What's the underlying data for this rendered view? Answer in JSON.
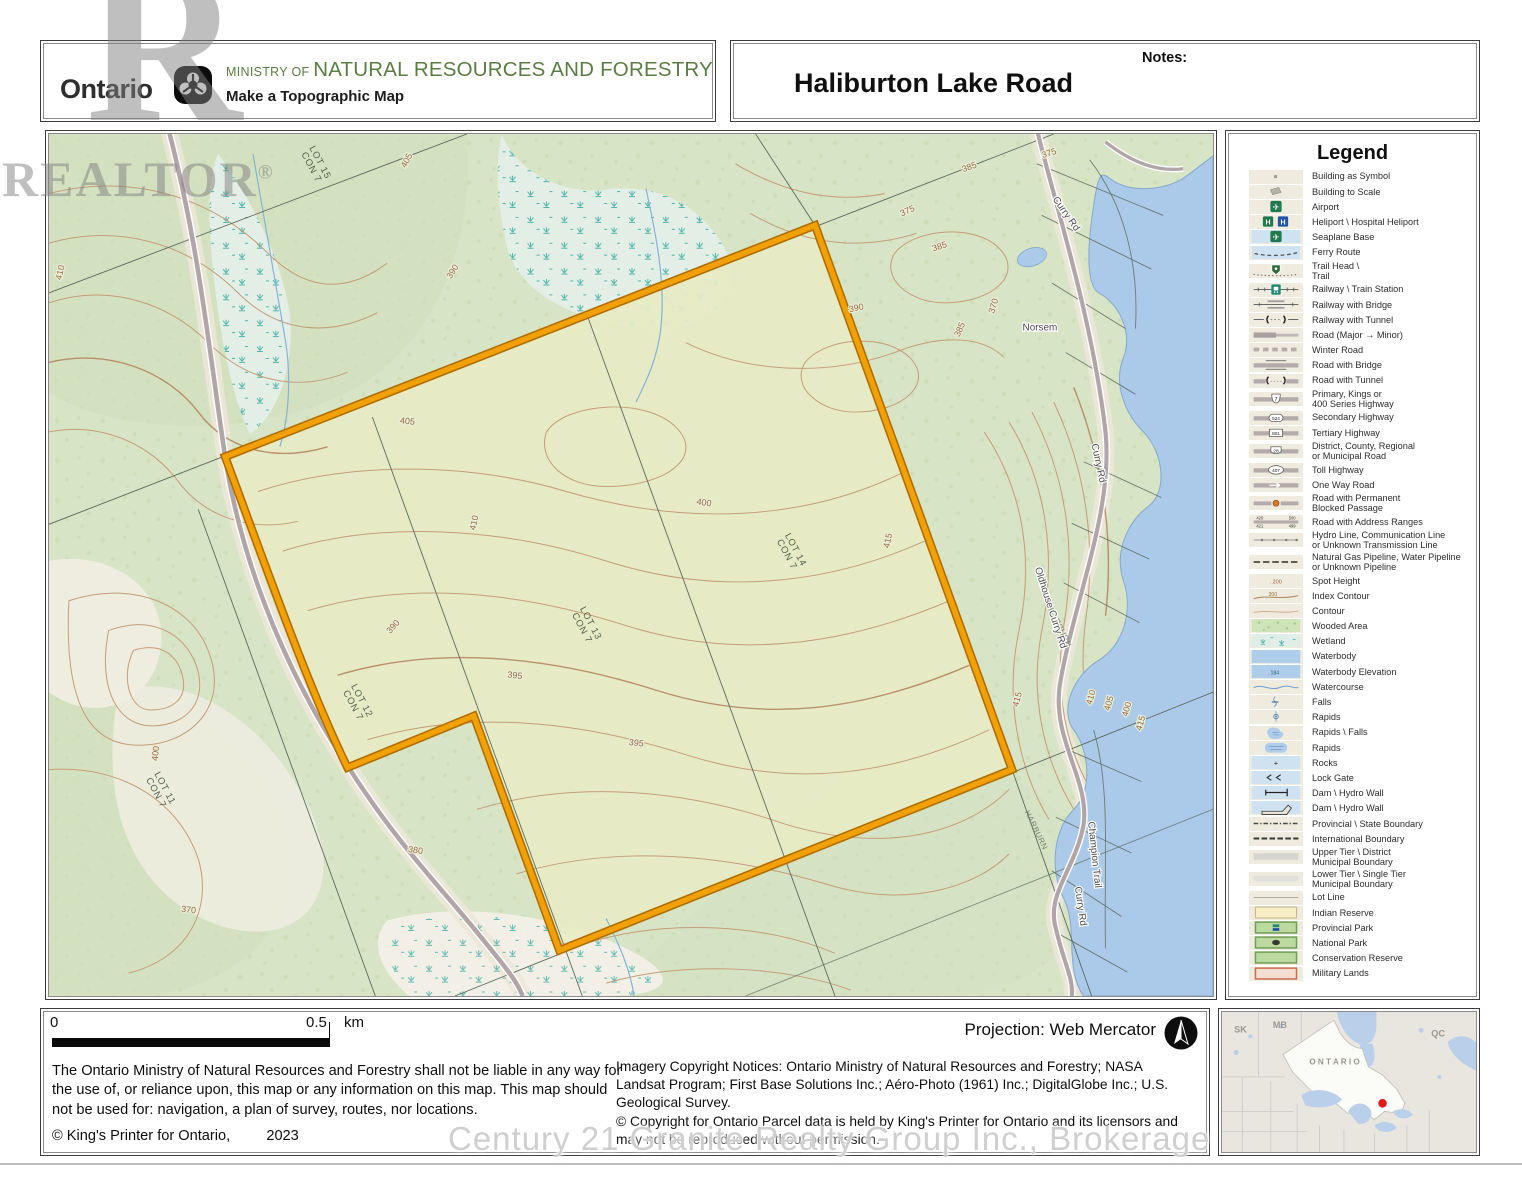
{
  "header": {
    "brand": "Ontario",
    "ministry_prefix": "MINISTRY OF ",
    "ministry_name": "NATURAL RESOURCES AND FORESTRY",
    "app_title": "Make a Topographic Map",
    "map_title": "Haliburton Lake Road",
    "notes_label": "Notes:"
  },
  "watermarks": {
    "realtor_r": "R",
    "realtor": "REALTOR",
    "registered": "®",
    "brokerage": "Century 21 Granite Realty Group Inc., Brokerage"
  },
  "legend": {
    "title": "Legend",
    "items": [
      {
        "label": "Building as Symbol",
        "sym": "building-symbol"
      },
      {
        "label": "Building to Scale",
        "sym": "building-scale"
      },
      {
        "label": "Airport",
        "sym": "airport"
      },
      {
        "label": "Heliport \\ Hospital Heliport",
        "sym": "heliport"
      },
      {
        "label": "Seaplane Base",
        "sym": "seaplane"
      },
      {
        "label": "Ferry Route",
        "sym": "ferry"
      },
      {
        "label": "Trail Head \\\nTrail",
        "sym": "trail"
      },
      {
        "label": "Railway \\ Train Station",
        "sym": "railway-station"
      },
      {
        "label": "Railway with Bridge",
        "sym": "railway-bridge"
      },
      {
        "label": "Railway with Tunnel",
        "sym": "railway-tunnel"
      },
      {
        "label": "Road (Major → Minor)",
        "sym": "road-major-minor"
      },
      {
        "label": "Winter Road",
        "sym": "winter-road"
      },
      {
        "label": "Road with Bridge",
        "sym": "road-bridge"
      },
      {
        "label": "Road with Tunnel",
        "sym": "road-tunnel"
      },
      {
        "label": "Primary, Kings or\n400 Series Highway",
        "sym": "hwy-primary",
        "num": "7"
      },
      {
        "label": "Secondary Highway",
        "sym": "hwy-secondary",
        "num": "524"
      },
      {
        "label": "Tertiary Highway",
        "sym": "hwy-tertiary",
        "num": "801"
      },
      {
        "label": "District, County, Regional\nor Municipal Road",
        "sym": "road-district",
        "num": "28"
      },
      {
        "label": "Toll Highway",
        "sym": "hwy-toll",
        "num": "407"
      },
      {
        "label": "One Way Road",
        "sym": "one-way"
      },
      {
        "label": "Road with Permanent\nBlocked Passage",
        "sym": "road-blocked"
      },
      {
        "label": "Road with Address Ranges",
        "sym": "road-address",
        "nums": [
          "420",
          "500",
          "421",
          "499"
        ]
      },
      {
        "label": "Hydro Line, Communication Line\nor Unknown Transmission Line",
        "sym": "hydro-line"
      },
      {
        "label": "Natural Gas Pipeline, Water Pipeline\nor Unknown Pipeline",
        "sym": "pipeline"
      },
      {
        "label": "Spot Height",
        "sym": "spot-height",
        "num": "200"
      },
      {
        "label": "Index Contour",
        "sym": "index-contour",
        "num": "200"
      },
      {
        "label": "Contour",
        "sym": "contour"
      },
      {
        "label": "Wooded Area",
        "sym": "wooded"
      },
      {
        "label": "Wetland",
        "sym": "wetland"
      },
      {
        "label": "Waterbody",
        "sym": "waterbody"
      },
      {
        "label": "Waterbody Elevation",
        "sym": "waterbody-elev",
        "num": "184"
      },
      {
        "label": "Watercourse",
        "sym": "watercourse"
      },
      {
        "label": "Falls",
        "sym": "falls"
      },
      {
        "label": "Rapids",
        "sym": "rapids-dot"
      },
      {
        "label": "Rapids \\ Falls",
        "sym": "rapids-falls"
      },
      {
        "label": "Rapids",
        "sym": "rapids-area"
      },
      {
        "label": "Rocks",
        "sym": "rocks"
      },
      {
        "label": "Lock Gate",
        "sym": "lock-gate"
      },
      {
        "label": "Dam \\ Hydro Wall",
        "sym": "dam1"
      },
      {
        "label": "Dam \\ Hydro Wall",
        "sym": "dam2"
      },
      {
        "label": "Provincial \\ State Boundary",
        "sym": "prov-boundary"
      },
      {
        "label": "International Boundary",
        "sym": "intl-boundary"
      },
      {
        "label": "Upper Tier \\ District\nMunicipal Boundary",
        "sym": "upper-tier"
      },
      {
        "label": "Lower Tier \\ Single Tier\nMunicipal Boundary",
        "sym": "lower-tier"
      },
      {
        "label": "Lot Line",
        "sym": "lot-line"
      },
      {
        "label": "Indian Reserve",
        "sym": "indian-reserve"
      },
      {
        "label": "Provincial Park",
        "sym": "prov-park"
      },
      {
        "label": "National Park",
        "sym": "natl-park"
      },
      {
        "label": "Conservation Reserve",
        "sym": "conservation"
      },
      {
        "label": "Military Lands",
        "sym": "military"
      }
    ]
  },
  "map": {
    "contour_labels": [
      {
        "t": "405",
        "x": 362,
        "y": 28,
        "r": -62
      },
      {
        "t": "410",
        "x": 14,
        "y": 140,
        "r": -78
      },
      {
        "t": "390",
        "x": 408,
        "y": 140,
        "r": -58
      },
      {
        "t": "375",
        "x": 1006,
        "y": 22,
        "r": -18
      },
      {
        "t": "385",
        "x": 926,
        "y": 36,
        "r": -20
      },
      {
        "t": "375",
        "x": 864,
        "y": 80,
        "r": -24
      },
      {
        "t": "385",
        "x": 896,
        "y": 116,
        "r": -18
      },
      {
        "t": "390",
        "x": 812,
        "y": 178,
        "r": -12
      },
      {
        "t": "370",
        "x": 952,
        "y": 174,
        "r": -72
      },
      {
        "t": "385",
        "x": 918,
        "y": 198,
        "r": -66
      },
      {
        "t": "405",
        "x": 360,
        "y": 292,
        "r": 6
      },
      {
        "t": "410",
        "x": 430,
        "y": 392,
        "r": -78
      },
      {
        "t": "400",
        "x": 658,
        "y": 374,
        "r": 8
      },
      {
        "t": "415",
        "x": 846,
        "y": 410,
        "r": -78
      },
      {
        "t": "395",
        "x": 468,
        "y": 548,
        "r": 6
      },
      {
        "t": "395",
        "x": 590,
        "y": 616,
        "r": 6
      },
      {
        "t": "390",
        "x": 348,
        "y": 498,
        "r": -48
      },
      {
        "t": "400",
        "x": 110,
        "y": 624,
        "r": -84
      },
      {
        "t": "380",
        "x": 368,
        "y": 724,
        "r": 8
      },
      {
        "t": "370",
        "x": 140,
        "y": 784,
        "r": 6
      },
      {
        "t": "415",
        "x": 976,
        "y": 570,
        "r": -74
      },
      {
        "t": "410",
        "x": 1050,
        "y": 568,
        "r": -74
      },
      {
        "t": "405",
        "x": 1068,
        "y": 574,
        "r": -74
      },
      {
        "t": "400",
        "x": 1086,
        "y": 580,
        "r": -74
      },
      {
        "t": "415",
        "x": 1100,
        "y": 594,
        "r": -74
      }
    ],
    "lot_labels": [
      {
        "l1": "LOT 15",
        "l2": "CON 7",
        "x": 270,
        "y": 30,
        "r": 62
      },
      {
        "l1": "LOT 14",
        "l2": "CON 7",
        "x": 748,
        "y": 420,
        "r": 62
      },
      {
        "l1": "LOT 13",
        "l2": "CON 7",
        "x": 542,
        "y": 494,
        "r": 62
      },
      {
        "l1": "LOT 12",
        "l2": "CON 7",
        "x": 312,
        "y": 572,
        "r": 62
      },
      {
        "l1": "LOT 11",
        "l2": "CON 7",
        "x": 114,
        "y": 660,
        "r": 62
      }
    ],
    "area_labels": [
      {
        "t": "HARBURN",
        "x": 1014,
        "y": 498,
        "r": 64
      },
      {
        "t": "HARBURN",
        "x": 990,
        "y": 702,
        "r": 64
      }
    ],
    "road_labels": [
      {
        "t": "Curry Rd",
        "x": 1020,
        "y": 82,
        "r": 55
      },
      {
        "t": "Norsem",
        "x": 996,
        "y": 198,
        "r": 0
      },
      {
        "t": "Curry Rd",
        "x": 1052,
        "y": 332,
        "r": 78
      },
      {
        "t": "Oldhouse Curry Rd",
        "x": 1004,
        "y": 478,
        "r": 72
      },
      {
        "t": "Champion Trail",
        "x": 1048,
        "y": 726,
        "r": 84
      },
      {
        "t": "Curry Rd",
        "x": 1034,
        "y": 778,
        "r": 82
      }
    ]
  },
  "footer": {
    "scale_zero": "0",
    "scale_half": "0.5",
    "scale_unit": "km",
    "disclaimer": "The Ontario Ministry of Natural Resources and Forestry shall not be liable in any way for the use of, or reliance upon, this map or any information on this map.  This map should not be used for: navigation, a plan of survey, routes, nor locations.",
    "kings_printer": "© King's Printer for Ontario,",
    "year": "2023",
    "projection": "Projection: Web Mercator",
    "imagery": "Imagery Copyright Notices: Ontario Ministry of Natural Resources and Forestry; NASA Landsat Program; First Base Solutions Inc.; Aéro-Photo (1961) Inc.; DigitalGlobe Inc.; U.S. Geological Survey.",
    "parcel_copyright": "© Copyright for Ontario Parcel data is held by King's Printer for Ontario and its licensors and may not be reproduced without permission."
  },
  "inset": {
    "labels": [
      "SK",
      "MB",
      "O N T A R I O",
      "QC"
    ]
  },
  "colors": {
    "ministry_green": "#5a7d44",
    "parcel_outline": "#f2a007",
    "parcel_fill": "#e7ecc4",
    "map_base_green": "#d8e4c6",
    "water_blue": "#abc9e9",
    "contour_brown": "#c49d79",
    "location_dot_red": "#e01818"
  }
}
